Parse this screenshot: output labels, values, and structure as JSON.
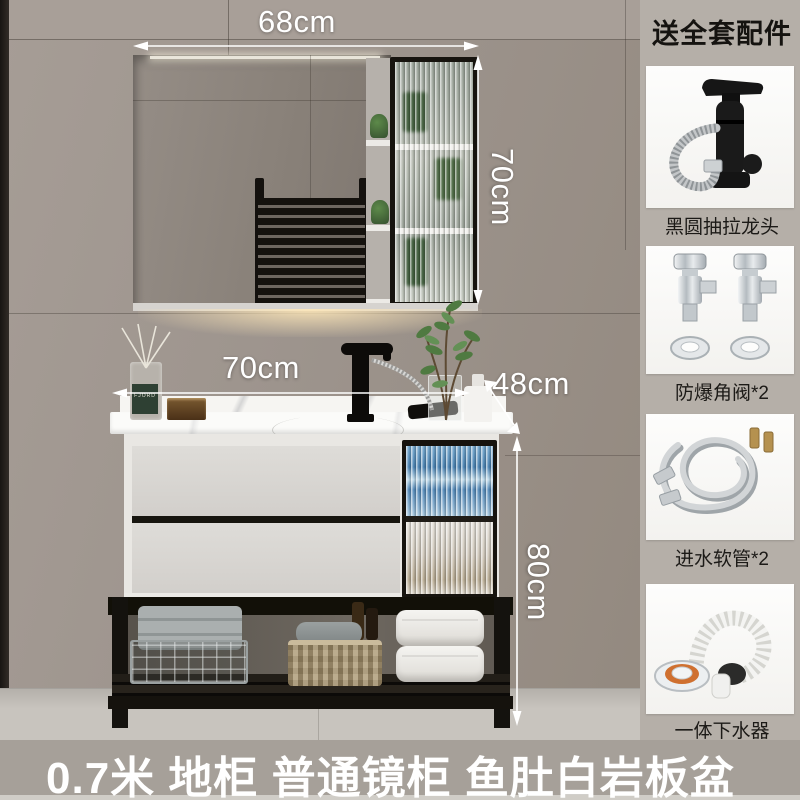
{
  "annotations": {
    "mirror_width": "68cm",
    "mirror_height": "70cm",
    "vanity_width": "70cm",
    "vanity_depth": "48cm",
    "vanity_height": "80cm"
  },
  "scene": {
    "diffuser_brand": "FJORD"
  },
  "sidebar": {
    "title": "送全套配件",
    "items": [
      {
        "name": "pull-out-faucet",
        "label": "黑圆抽拉龙头"
      },
      {
        "name": "angle-valves",
        "label": "防爆角阀*2"
      },
      {
        "name": "inlet-hoses",
        "label": "进水软管*2"
      },
      {
        "name": "integrated-drain",
        "label": "一体下水器"
      }
    ]
  },
  "footer": {
    "headline": "0.7米  地柜  普通镜柜  鱼肚白岩板盆"
  },
  "colors": {
    "wall": "#9d948d",
    "sidebar_bg": "#b5afa8",
    "card_bg": "#fbfbfa",
    "floor": "#c7c3bd",
    "bottom_band": "#a6a099",
    "annotation_text": "#ffffff",
    "headline_text": "#ffffff",
    "title_text": "#151310",
    "glass_accent_blue": "#4f8cc0"
  }
}
